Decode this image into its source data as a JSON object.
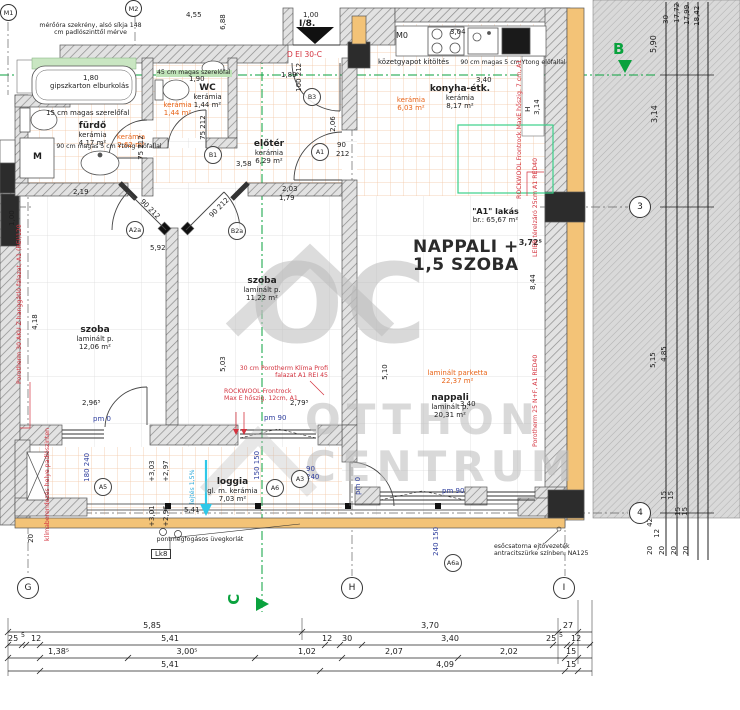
{
  "colors": {
    "wall_fill": "#f3c377",
    "hatch": "#8a8a8a",
    "annotation_red": "#d4333f",
    "area_orange": "#e8651a",
    "axis_green": "#0aa23e",
    "dim_navy": "#2f3f9e",
    "slope_cyan": "#2aa8d8",
    "watermark_gray": "#c6c6c6",
    "highlight_green": "#bfe3b8"
  },
  "watermark": {
    "monogram": "OC",
    "line1": "OTTHON",
    "line2": "CENTRUM"
  },
  "entrance": {
    "unit": "I/8.",
    "door_spec": "D EI 30-C"
  },
  "apartment": {
    "name": "\"A1\" lakás",
    "area": "br.: 65,67 m²",
    "headline1": "NAPPALI +",
    "elevation": "3,72⁵",
    "headline2": "1,5 SZOBA"
  },
  "rooms": {
    "furdo": {
      "name": "fürdő",
      "finish": "kerámia",
      "area": "4,17 m²"
    },
    "furdo2": {
      "finish": "kerámia",
      "area": "2,62 m²"
    },
    "wc": {
      "name": "WC",
      "finish": "kerámia",
      "area": "1,44 m²"
    },
    "wc2": {
      "finish": "kerámia",
      "area": "1,44 m²"
    },
    "eloter": {
      "name": "előtér",
      "finish": "kerámia",
      "area": "6,29 m²"
    },
    "konyha": {
      "name": "konyha-étk.",
      "finish": "kerámia",
      "area": "8,17 m²"
    },
    "konyha2": {
      "finish": "kerámia",
      "area": "6,03 m²"
    },
    "szoba1": {
      "name": "szoba",
      "finish": "laminált p.",
      "area": "12,06 m²"
    },
    "szoba2": {
      "name": "szoba",
      "finish": "laminált p.",
      "area": "11,22 m²"
    },
    "nappali": {
      "name": "nappali",
      "finish": "laminált p.",
      "area": "20,31 m²"
    },
    "nappali2": {
      "finish": "laminált parketta",
      "area": "22,37 m²"
    },
    "loggia": {
      "name": "loggia",
      "finish": "gl. m. kerámia",
      "area": "7,03 m²"
    }
  },
  "annotations": {
    "meter_cabinet": "mérőóra szekrény, alsó síkja 148 cm padlószinttől mérve",
    "gipszkarton": "gipszkarton elburkolás",
    "szerelofal_15": "15 cm magas szerelőfal",
    "ytong_bath": "90 cm magas 5 cm Ytong előfallal",
    "szerelofal_45": "45 cm magas szerelőfal",
    "kozetgyapot": "közetgyapot kitöltés",
    "ytong_kitchen": "90 cm magas 5 cm Ytong előfallal",
    "porotherm30": "Porotherm 30 AKU Z hanggátló falazat, A1 (REI)120",
    "porotherm30_klima": "30 cm Porotherm Klíma Profi falazat A1 REI 45",
    "rockwool12": "ROCKWOOL Frontrock Max E hőszig. 12cm, A1",
    "rockwool7": "ROCKWOOL Frontrock MaxE hőszig. 7 cm, A1",
    "leier": "LEIER térelzáró 25cm A1 RED40",
    "porotherm25": "Porotherm 25 N+F, A1 RED40",
    "klima": "klímaberendezés helye padlószinten",
    "uvegkorlat": "pontmegfogásos üvegkorlát",
    "lk8": "Lk8",
    "esocsatorna": "esőcsatorna ejtővezeték antracitszürke színben, NA125",
    "lejtes": "lejtés 1,5%"
  },
  "markers": {
    "m1": "M1",
    "m2": "M2",
    "m0": "M0",
    "b1": "B1",
    "b3": "B3",
    "a1": "A1",
    "a2a": "A2a",
    "b2a": "B2a",
    "a3": "A3",
    "a5": "A5",
    "a6": "A6",
    "a6a": "A6a"
  },
  "grid": {
    "g": "G",
    "c": "C",
    "h": "H",
    "i": "I",
    "b": "B",
    "n3": "3",
    "n4": "4"
  },
  "dims": {
    "bottom1": [
      "5,85",
      "3,70",
      "27"
    ],
    "bottom2": [
      "25",
      "5",
      "12",
      "5,41",
      "12",
      "30",
      "3,40",
      "25",
      "5",
      "12"
    ],
    "bottom3": [
      "1,38⁵",
      "3,00⁵",
      "1,02",
      "2,07",
      "2,02",
      "15"
    ],
    "bottom4": [
      "5,41",
      "4,09",
      "15"
    ],
    "right_top": [
      "5,90",
      "30",
      "17,72",
      "17,99",
      "18,42",
      "3,14"
    ],
    "right_mid": [
      "5,15",
      "4,85"
    ],
    "right_bottom": [
      "42",
      "12",
      "15",
      "15",
      "15",
      "15",
      "20",
      "20",
      "20",
      "20"
    ],
    "t455": "4,55",
    "t688": "6,88",
    "t100": "1,00",
    "t50": "50",
    "bath180": "1,80",
    "bath_door": "75 212",
    "wc_door": "75 212",
    "wc190": "1,90",
    "entry189": "1,89",
    "entry_door": "100 212",
    "el203": "2,03",
    "el179": "1,79",
    "el358": "3,58",
    "el206": "2,06",
    "el_door_w": "90",
    "el_door_h": "212",
    "s1_219": "2,19",
    "s1_100": "1,00",
    "s1_418": "4,18",
    "s1_296": "2,96⁵",
    "s1_door": "90 212",
    "s1_pm": "pm 0",
    "s2_592": "5,92",
    "s2_503": "5,03",
    "s2_door": "90 212",
    "s2_pm": "pm 90",
    "n510": "5,10",
    "n340": "3,40",
    "n279": "2,79⁵",
    "n844": "8,44",
    "n_pm": "pm 90",
    "n_pm0": "pm 0",
    "k304": "3,04",
    "k340": "3,40",
    "kh": "H",
    "kh314": "3,14",
    "lg180": "180 240",
    "lg150": "150 150",
    "lg90_240": "90 240",
    "lg240_150": "240 150",
    "lv303": "+3,03",
    "lv297": "+2,97",
    "lv301": "+3,01",
    "lv296": "+2,96",
    "lg541": "5,41",
    "lg20": "20"
  }
}
